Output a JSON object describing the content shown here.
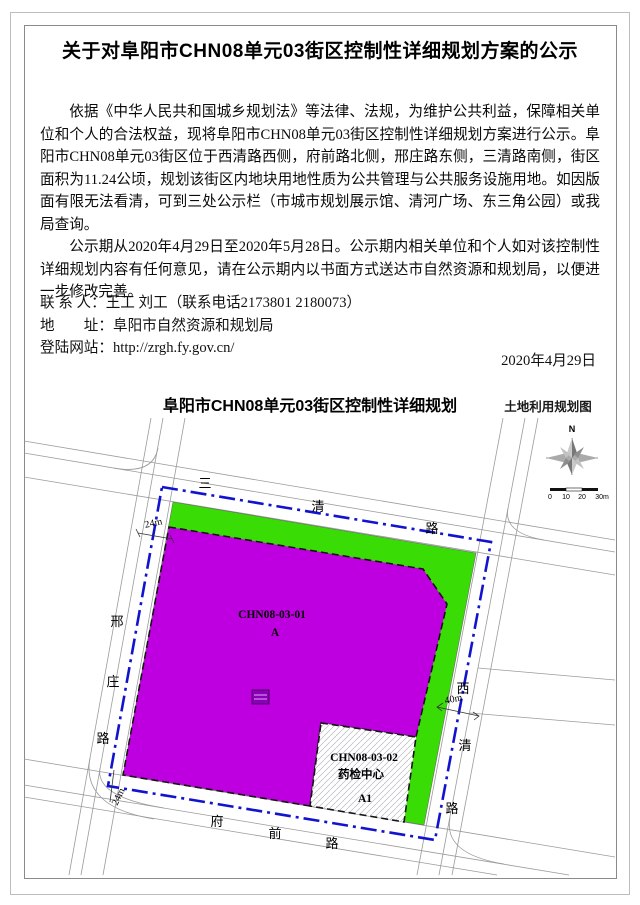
{
  "doc": {
    "title": "关于对阜阳市CHN08单元03街区控制性详细规划方案的公示",
    "paragraphs": [
      "依据《中华人民共和国城乡规划法》等法律、法规，为维护公共利益，保障相关单位和个人的合法权益，现将阜阳市CHN08单元03街区控制性详细规划方案进行公示。阜阳市CHN08单元03街区位于西清路西侧，府前路北侧，邢庄路东侧，三清路南侧，街区面积为11.24公顷，规划该街区内地块用地性质为公共管理与公共服务设施用地。如因版面有限无法看清，可到三处公示栏（市城市规划展示馆、清河广场、东三角公园）或我局查询。",
      "公示期从2020年4月29日至2020年5月28日。公示期内相关单位和个人如对该控制性详细规划内容有任何意见，请在公示期内以书面方式送达市自然资源和规划局，以便进一步修改完善。"
    ],
    "contact": {
      "rows": [
        {
          "label": "联 系 人：",
          "value": "王工 刘工（联系电话2173801 2180073）"
        },
        {
          "label": "地　　址：",
          "value": "阜阳市自然资源和规划局"
        },
        {
          "label": "登陆网站：",
          "value": "http://zrgh.fy.gov.cn/"
        }
      ]
    },
    "date": "2020年4月29日"
  },
  "map": {
    "title": "阜阳市CHN08单元03街区控制性详细规划",
    "legend": "土地利用规划图",
    "compass": {
      "north": "N"
    },
    "scale_ticks": [
      "0",
      "10",
      "20",
      "30m"
    ],
    "roads": {
      "top": {
        "name": "三清路",
        "chars": [
          "三",
          "清",
          "路"
        ]
      },
      "left": {
        "name": "邢庄路",
        "chars": [
          "邢",
          "庄",
          "路"
        ]
      },
      "right": {
        "name": "西清路",
        "chars": [
          "西",
          "清",
          "路"
        ]
      },
      "bottom": {
        "name": "府前路",
        "chars": [
          "府",
          "前",
          "路"
        ]
      }
    },
    "dimensions": {
      "left_road_width": "24m",
      "bottom_road_width": "24m",
      "right_road_width": "40m"
    },
    "parcels": [
      {
        "code": "CHN08-03-01",
        "use_code": "A",
        "fill": "#BE00E0"
      },
      {
        "code": "CHN08-03-02",
        "name": "药检中心",
        "use_code": "A1",
        "fill": "hatched-white"
      }
    ],
    "colors": {
      "boundary_blue": "#1213CE",
      "green_space": "#39DC04",
      "parcel_purple": "#BE00E0"
    }
  }
}
